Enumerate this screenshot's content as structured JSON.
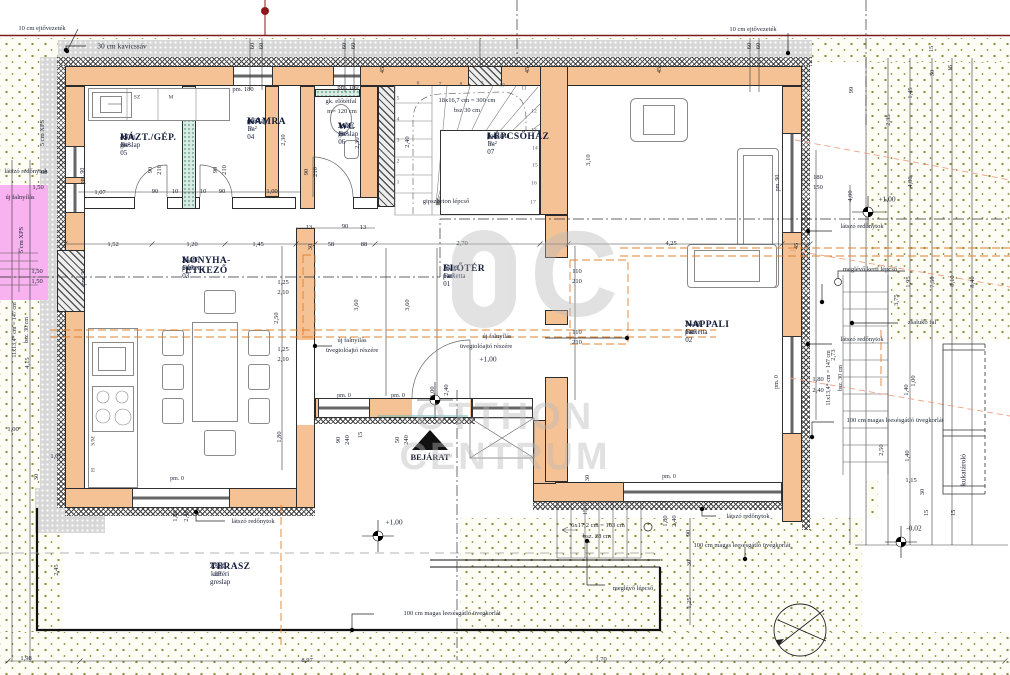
{
  "watermark": {
    "word1": "OTTHON",
    "word2": "CENTRUM",
    "logo_letter": "C"
  },
  "compass": {
    "north_label": "É"
  },
  "rooms": [
    {
      "code": "A-F-05",
      "name": "HÁZT./GÉP.",
      "finish": "cs.m. greslap",
      "area": "4,76 m²",
      "x": 120,
      "y": 133
    },
    {
      "code": "A-F-04",
      "name": "KAMRA",
      "finish": "greslap",
      "area": "4,60 m²",
      "x": 247,
      "y": 117
    },
    {
      "code": "A-F-06",
      "name": "WC",
      "finish": "cs.m. greslap",
      "area": "2,68 m²",
      "x": 338,
      "y": 122
    },
    {
      "code": "A-F-07",
      "name": "LÉPCSŐHÁZ",
      "finish": "parketta",
      "area": "5,43 m²",
      "x": 487,
      "y": 132
    },
    {
      "code": "A-F-03",
      "name": "KONYHA-ÉTKEZŐ",
      "finish": "lam. parketta",
      "area": "21,27 m²",
      "x": 182,
      "y": 256
    },
    {
      "code": "A-F-01",
      "name": "ELŐTÉR",
      "finish": "lam. parketta",
      "area": "15,99 m²",
      "x": 443,
      "y": 264
    },
    {
      "code": "A-F-02",
      "name": "NAPPALI",
      "finish": "lam. parketta",
      "area": "31,87 m²",
      "x": 685,
      "y": 320
    },
    {
      "code": "A",
      "name": "TERASZ",
      "finish": "cs.m. kültéri greslap",
      "area": "27,80 m²",
      "x": 210,
      "y": 562
    }
  ],
  "labels": [
    {
      "t": "30 cm kavicssáv",
      "x": 122,
      "y": 46,
      "k": "a",
      "s": 7.5
    },
    {
      "t": "10 cm ejtővezeték",
      "x": 42,
      "y": 29,
      "k": "a"
    },
    {
      "t": "10 cm ejtővezeték",
      "x": 753,
      "y": 30,
      "k": "a"
    },
    {
      "t": "5 cm XPS",
      "x": 43,
      "y": 133,
      "r": -90,
      "k": "a"
    },
    {
      "t": "5 cm XPS",
      "x": 22,
      "y": 240,
      "r": -90,
      "k": "a"
    },
    {
      "t": "látszó redőnytok",
      "x": 26,
      "y": 172,
      "k": "a",
      "s": 6.5
    },
    {
      "t": "új falnyílás",
      "x": 20,
      "y": 198,
      "k": "a"
    },
    {
      "t": "pm. 180",
      "x": 243,
      "y": 90,
      "k": "a"
    },
    {
      "t": "pm. 180",
      "x": 348,
      "y": 88,
      "k": "a"
    },
    {
      "t": "gk. előtétfal",
      "x": 341,
      "y": 102,
      "k": "a",
      "s": 6.5
    },
    {
      "t": "m= 120 cm",
      "x": 342,
      "y": 112,
      "k": "a",
      "s": 6.5
    },
    {
      "t": "18x16,7 cm = 300 cm",
      "x": 467,
      "y": 101,
      "k": "a",
      "s": 6.5
    },
    {
      "t": "bsz 30 cm",
      "x": 467,
      "y": 111,
      "k": "a",
      "s": 6.5
    },
    {
      "t": "gipszbeton lépcső",
      "x": 446,
      "y": 202,
      "k": "a"
    },
    {
      "t": "új falnyílás",
      "x": 352,
      "y": 341,
      "k": "a"
    },
    {
      "t": "üvegtolóajtó részére",
      "x": 352,
      "y": 351,
      "k": "a"
    },
    {
      "t": "új falnyílás",
      "x": 497,
      "y": 337,
      "k": "a"
    },
    {
      "t": "üvegtolóajtó részére",
      "x": 486,
      "y": 347,
      "k": "a"
    },
    {
      "t": "+1,00",
      "x": 488,
      "y": 359,
      "k": "a",
      "s": 7.5
    },
    {
      "t": "BEJÁRAT",
      "x": 430,
      "y": 457,
      "k": "a",
      "s": 8.5,
      "b": 1
    },
    {
      "t": "látszó redőnytok",
      "x": 253,
      "y": 522,
      "k": "a"
    },
    {
      "t": "látszó redőnytok",
      "x": 748,
      "y": 517,
      "k": "a"
    },
    {
      "t": "látszó redőnytok",
      "x": 862,
      "y": 227,
      "k": "a"
    },
    {
      "t": "látszó redőnytok",
      "x": 862,
      "y": 340,
      "k": "a"
    },
    {
      "t": "meglévő kerti lépcső",
      "x": 870,
      "y": 270,
      "k": "a"
    },
    {
      "t": "zsalukő fal",
      "x": 922,
      "y": 323,
      "k": "a"
    },
    {
      "t": "meglévő lépcső",
      "x": 633,
      "y": 589,
      "k": "a"
    },
    {
      "t": "6x17,2 cm = 103 cm",
      "x": 598,
      "y": 526,
      "k": "a",
      "s": 6.5
    },
    {
      "t": "bsz. 28 cm",
      "x": 597,
      "y": 537,
      "k": "a",
      "s": 6.5
    },
    {
      "t": "100 cm magas leesésgátló üvegkorlát",
      "x": 452,
      "y": 614,
      "k": "a"
    },
    {
      "t": "100 cm magas leesésgátló üvegkorlát",
      "x": 742,
      "y": 546,
      "k": "a"
    },
    {
      "t": "100 cm magas leesésgátló üvegkorlát",
      "x": 895,
      "y": 421,
      "k": "a"
    },
    {
      "t": "11x13,4* cm = 147 cm",
      "x": 829,
      "y": 378,
      "r": -90,
      "k": "a",
      "s": 6
    },
    {
      "t": "bsz. 30 cm",
      "x": 841,
      "y": 378,
      "r": -90,
      "k": "a",
      "s": 6
    },
    {
      "t": "11x13,4* cm = 147 cm",
      "x": 15,
      "y": 330,
      "r": -90,
      "k": "a",
      "s": 6
    },
    {
      "t": "bsz. 30 cm",
      "x": 27,
      "y": 330,
      "r": -90,
      "k": "a",
      "s": 6
    },
    {
      "t": "kukatároló",
      "x": 963,
      "y": 470,
      "r": -90,
      "k": "a",
      "s": 7.5
    },
    {
      "t": "+1,00",
      "x": 394,
      "y": 522,
      "k": "a",
      "s": 7.5
    },
    {
      "t": "-0,02",
      "x": 914,
      "y": 528,
      "k": "a",
      "s": 7.5
    },
    {
      "t": "+1,00",
      "x": 887,
      "y": 199,
      "k": "a",
      "s": 7.5
    },
    {
      "t": "pm. 0",
      "x": 344,
      "y": 396,
      "k": "a",
      "s": 6
    },
    {
      "t": "pm. 0",
      "x": 398,
      "y": 396,
      "k": "a",
      "s": 6
    },
    {
      "t": "pm. 0",
      "x": 177,
      "y": 479,
      "k": "a",
      "s": 6
    },
    {
      "t": "pm. 0",
      "x": 777,
      "y": 382,
      "r": -90,
      "k": "a",
      "s": 6
    },
    {
      "t": "pm. 0",
      "x": 669,
      "y": 477,
      "k": "a",
      "s": 6
    },
    {
      "t": "pm. 90",
      "x": 83,
      "y": 176,
      "r": -90,
      "k": "a",
      "s": 6
    },
    {
      "t": "pm. 90",
      "x": 84,
      "y": 277,
      "r": -90,
      "k": "a",
      "s": 6
    },
    {
      "t": "pm. 90",
      "x": 778,
      "y": 183,
      "r": -90,
      "k": "a",
      "s": 6
    },
    {
      "t": "1,52",
      "x": 113,
      "y": 245,
      "k": "d"
    },
    {
      "t": "1,20",
      "x": 192,
      "y": 245,
      "k": "d"
    },
    {
      "t": "1,45",
      "x": 258,
      "y": 245,
      "k": "d"
    },
    {
      "t": "30",
      "x": 311,
      "y": 247,
      "r": -90,
      "k": "d"
    },
    {
      "t": "58",
      "x": 331,
      "y": 245,
      "k": "d"
    },
    {
      "t": "88",
      "x": 364,
      "y": 245,
      "k": "d"
    },
    {
      "t": "2,70",
      "x": 462,
      "y": 244,
      "k": "d"
    },
    {
      "t": "4,25",
      "x": 671,
      "y": 244,
      "k": "d"
    },
    {
      "t": "45",
      "x": 797,
      "y": 246,
      "r": -90,
      "k": "d"
    },
    {
      "t": "13",
      "x": 309,
      "y": 228,
      "k": "d"
    },
    {
      "t": "90",
      "x": 345,
      "y": 227,
      "k": "d"
    },
    {
      "t": "13",
      "x": 363,
      "y": 228,
      "k": "d"
    },
    {
      "t": "1,07",
      "x": 100,
      "y": 193,
      "k": "d"
    },
    {
      "t": "90",
      "x": 155,
      "y": 192,
      "k": "d"
    },
    {
      "t": "10",
      "x": 175,
      "y": 192,
      "k": "d"
    },
    {
      "t": "10",
      "x": 203,
      "y": 192,
      "k": "d"
    },
    {
      "t": "90",
      "x": 222,
      "y": 192,
      "k": "d"
    },
    {
      "t": "1,00",
      "x": 272,
      "y": 192,
      "k": "d"
    },
    {
      "t": "90",
      "x": 151,
      "y": 170,
      "r": -90,
      "k": "d"
    },
    {
      "t": "210",
      "x": 160,
      "y": 170,
      "r": -90,
      "k": "d"
    },
    {
      "t": "90",
      "x": 216,
      "y": 170,
      "r": -90,
      "k": "d"
    },
    {
      "t": "210",
      "x": 225,
      "y": 170,
      "r": -90,
      "k": "d"
    },
    {
      "t": "90",
      "x": 307,
      "y": 172,
      "r": -90,
      "k": "d"
    },
    {
      "t": "210",
      "x": 316,
      "y": 172,
      "r": -90,
      "k": "d"
    },
    {
      "t": "2,30",
      "x": 284,
      "y": 140,
      "r": -90,
      "k": "d"
    },
    {
      "t": "2,30",
      "x": 358,
      "y": 143,
      "r": -90,
      "k": "d"
    },
    {
      "t": "2,40",
      "x": 408,
      "y": 142,
      "r": -90,
      "k": "d"
    },
    {
      "t": "60",
      "x": 253,
      "y": 46,
      "r": -90,
      "k": "d"
    },
    {
      "t": "60",
      "x": 262,
      "y": 46,
      "r": -90,
      "k": "d"
    },
    {
      "t": "60",
      "x": 345,
      "y": 46,
      "r": -90,
      "k": "d"
    },
    {
      "t": "60",
      "x": 354,
      "y": 46,
      "r": -90,
      "k": "d"
    },
    {
      "t": "60",
      "x": 750,
      "y": 46,
      "r": -90,
      "k": "d"
    },
    {
      "t": "60",
      "x": 759,
      "y": 46,
      "r": -90,
      "k": "d"
    },
    {
      "t": "45",
      "x": 383,
      "y": 70,
      "r": -90,
      "k": "d"
    },
    {
      "t": "45",
      "x": 528,
      "y": 70,
      "r": -90,
      "k": "d"
    },
    {
      "t": "45",
      "x": 660,
      "y": 70,
      "r": -90,
      "k": "d"
    },
    {
      "t": "1,50",
      "x": 38,
      "y": 188,
      "k": "d"
    },
    {
      "t": "60",
      "x": 44,
      "y": 173,
      "k": "d"
    },
    {
      "t": "1,50",
      "x": 37,
      "y": 272,
      "k": "d"
    },
    {
      "t": "1,50",
      "x": 37,
      "y": 282,
      "k": "d"
    },
    {
      "t": "1,25",
      "x": 283,
      "y": 283,
      "k": "d"
    },
    {
      "t": "2,10",
      "x": 283,
      "y": 293,
      "k": "d"
    },
    {
      "t": "2,50",
      "x": 277,
      "y": 318,
      "r": -90,
      "k": "d"
    },
    {
      "t": "1,25",
      "x": 283,
      "y": 350,
      "k": "d"
    },
    {
      "t": "2,10",
      "x": 283,
      "y": 360,
      "k": "d"
    },
    {
      "t": "1,80",
      "x": 280,
      "y": 437,
      "r": -90,
      "k": "d"
    },
    {
      "t": "3,60",
      "x": 357,
      "y": 305,
      "r": -90,
      "k": "d"
    },
    {
      "t": "3,60",
      "x": 408,
      "y": 305,
      "r": -90,
      "k": "d"
    },
    {
      "t": "110",
      "x": 577,
      "y": 272,
      "k": "d"
    },
    {
      "t": "210",
      "x": 577,
      "y": 282,
      "k": "d"
    },
    {
      "t": "110",
      "x": 577,
      "y": 333,
      "k": "d"
    },
    {
      "t": "210",
      "x": 577,
      "y": 343,
      "k": "d"
    },
    {
      "t": "3,10",
      "x": 589,
      "y": 160,
      "r": -90,
      "k": "d"
    },
    {
      "t": "180",
      "x": 818,
      "y": 178,
      "k": "d"
    },
    {
      "t": "150",
      "x": 818,
      "y": 188,
      "k": "d"
    },
    {
      "t": "1,80",
      "x": 818,
      "y": 380,
      "k": "d"
    },
    {
      "t": "2,40",
      "x": 818,
      "y": 391,
      "k": "d"
    },
    {
      "t": "2,73",
      "x": 834,
      "y": 355,
      "r": -90,
      "k": "d"
    },
    {
      "t": "4,00",
      "x": 851,
      "y": 196,
      "r": -90,
      "k": "d"
    },
    {
      "t": "99",
      "x": 852,
      "y": 90,
      "r": -90,
      "k": "d"
    },
    {
      "t": "2,35",
      "x": 889,
      "y": 120,
      "r": -90,
      "k": "d"
    },
    {
      "t": "1,45",
      "x": 911,
      "y": 93,
      "r": -90,
      "k": "d"
    },
    {
      "t": "15",
      "x": 932,
      "y": 49,
      "r": -90,
      "k": "d"
    },
    {
      "t": "30",
      "x": 933,
      "y": 73,
      "r": -90,
      "k": "d"
    },
    {
      "t": "15",
      "x": 951,
      "y": 68,
      "r": -90,
      "k": "d"
    },
    {
      "t": "4,80",
      "x": 911,
      "y": 182,
      "r": -90,
      "k": "d"
    },
    {
      "t": "1,95",
      "x": 909,
      "y": 282,
      "r": -90,
      "k": "d"
    },
    {
      "t": "3,75",
      "x": 897,
      "y": 300,
      "r": -90,
      "k": "d"
    },
    {
      "t": "7,50",
      "x": 933,
      "y": 282,
      "r": -90,
      "k": "d"
    },
    {
      "t": "8,10",
      "x": 953,
      "y": 281,
      "r": -90,
      "k": "d"
    },
    {
      "t": "8,40",
      "x": 973,
      "y": 282,
      "r": -90,
      "k": "d"
    },
    {
      "t": "1,00",
      "x": 914,
      "y": 381,
      "r": -90,
      "k": "d"
    },
    {
      "t": "1,80",
      "x": 176,
      "y": 516,
      "r": -90,
      "k": "d"
    },
    {
      "t": "2,40",
      "x": 187,
      "y": 516,
      "r": -90,
      "k": "d"
    },
    {
      "t": "1,80",
      "x": 666,
      "y": 521,
      "r": -90,
      "k": "d"
    },
    {
      "t": "2,40",
      "x": 675,
      "y": 521,
      "r": -90,
      "k": "d"
    },
    {
      "t": "90",
      "x": 689,
      "y": 533,
      "r": -90,
      "k": "d"
    },
    {
      "t": "30",
      "x": 690,
      "y": 563,
      "r": -90,
      "k": "d"
    },
    {
      "t": "1,25",
      "x": 690,
      "y": 603,
      "r": -90,
      "k": "d"
    },
    {
      "t": "2,50",
      "x": 882,
      "y": 450,
      "r": -90,
      "k": "d"
    },
    {
      "t": "1,40",
      "x": 907,
      "y": 390,
      "r": -90,
      "k": "d"
    },
    {
      "t": "1,40",
      "x": 908,
      "y": 456,
      "r": -90,
      "k": "d"
    },
    {
      "t": "1,15",
      "x": 911,
      "y": 481,
      "k": "d"
    },
    {
      "t": "30",
      "x": 923,
      "y": 492,
      "r": -90,
      "k": "d"
    },
    {
      "t": "15",
      "x": 927,
      "y": 513,
      "r": -90,
      "k": "d"
    },
    {
      "t": "15",
      "x": 954,
      "y": 513,
      "r": -90,
      "k": "d"
    },
    {
      "t": "1,05",
      "x": 56,
      "y": 457,
      "k": "d"
    },
    {
      "t": "30",
      "x": 37,
      "y": 477,
      "r": -90,
      "k": "d"
    },
    {
      "t": "1,00",
      "x": 13,
      "y": 430,
      "k": "d"
    },
    {
      "t": "2,45",
      "x": 57,
      "y": 570,
      "r": -90,
      "k": "d"
    },
    {
      "t": "4,15",
      "x": 28,
      "y": 363,
      "r": -90,
      "k": "d"
    },
    {
      "t": "1,98",
      "x": 26,
      "y": 659,
      "k": "d"
    },
    {
      "t": "8,97",
      "x": 307,
      "y": 661,
      "k": "d"
    },
    {
      "t": "1,70",
      "x": 601,
      "y": 660,
      "k": "d"
    },
    {
      "t": "15",
      "x": 361,
      "y": 435,
      "r": -90,
      "k": "d"
    },
    {
      "t": "50",
      "x": 398,
      "y": 440,
      "r": -90,
      "k": "d"
    },
    {
      "t": "240",
      "x": 407,
      "y": 440,
      "r": -90,
      "k": "d"
    },
    {
      "t": "90",
      "x": 339,
      "y": 440,
      "r": -90,
      "k": "d"
    },
    {
      "t": "240",
      "x": 348,
      "y": 440,
      "r": -90,
      "k": "d"
    },
    {
      "t": "1,00",
      "x": 433,
      "y": 392,
      "r": -90,
      "k": "d"
    },
    {
      "t": "2,40",
      "x": 447,
      "y": 390,
      "r": -90,
      "k": "d"
    },
    {
      "t": "30",
      "x": 588,
      "y": 478,
      "r": -90,
      "k": "d"
    },
    {
      "t": "15",
      "x": 586,
      "y": 512,
      "r": -90,
      "k": "d"
    }
  ],
  "stair_numbers": [
    {
      "t": "1",
      "x": 398,
      "y": 183
    },
    {
      "t": "2",
      "x": 398,
      "y": 162
    },
    {
      "t": "3",
      "x": 398,
      "y": 141
    },
    {
      "t": "4",
      "x": 398,
      "y": 120
    },
    {
      "t": "5",
      "x": 398,
      "y": 99
    },
    {
      "t": "6",
      "x": 418,
      "y": 84
    },
    {
      "t": "7",
      "x": 440,
      "y": 85
    },
    {
      "t": "8",
      "x": 461,
      "y": 85
    },
    {
      "t": "9",
      "x": 482,
      "y": 84
    },
    {
      "t": "10",
      "x": 502,
      "y": 86
    },
    {
      "t": "11",
      "x": 524,
      "y": 89
    },
    {
      "t": "12",
      "x": 534,
      "y": 112
    },
    {
      "t": "13",
      "x": 534,
      "y": 131
    },
    {
      "t": "14",
      "x": 535,
      "y": 149
    },
    {
      "t": "15",
      "x": 535,
      "y": 166
    },
    {
      "t": "16",
      "x": 534,
      "y": 184
    },
    {
      "t": "17",
      "x": 533,
      "y": 203
    }
  ],
  "appliance_labels": [
    {
      "t": "SZ",
      "x": 137,
      "y": 98
    },
    {
      "t": "M",
      "x": 171,
      "y": 98
    },
    {
      "t": "S/M",
      "x": 94,
      "y": 441,
      "r": -90
    },
    {
      "t": "H",
      "x": 94,
      "y": 470,
      "r": -90
    }
  ]
}
